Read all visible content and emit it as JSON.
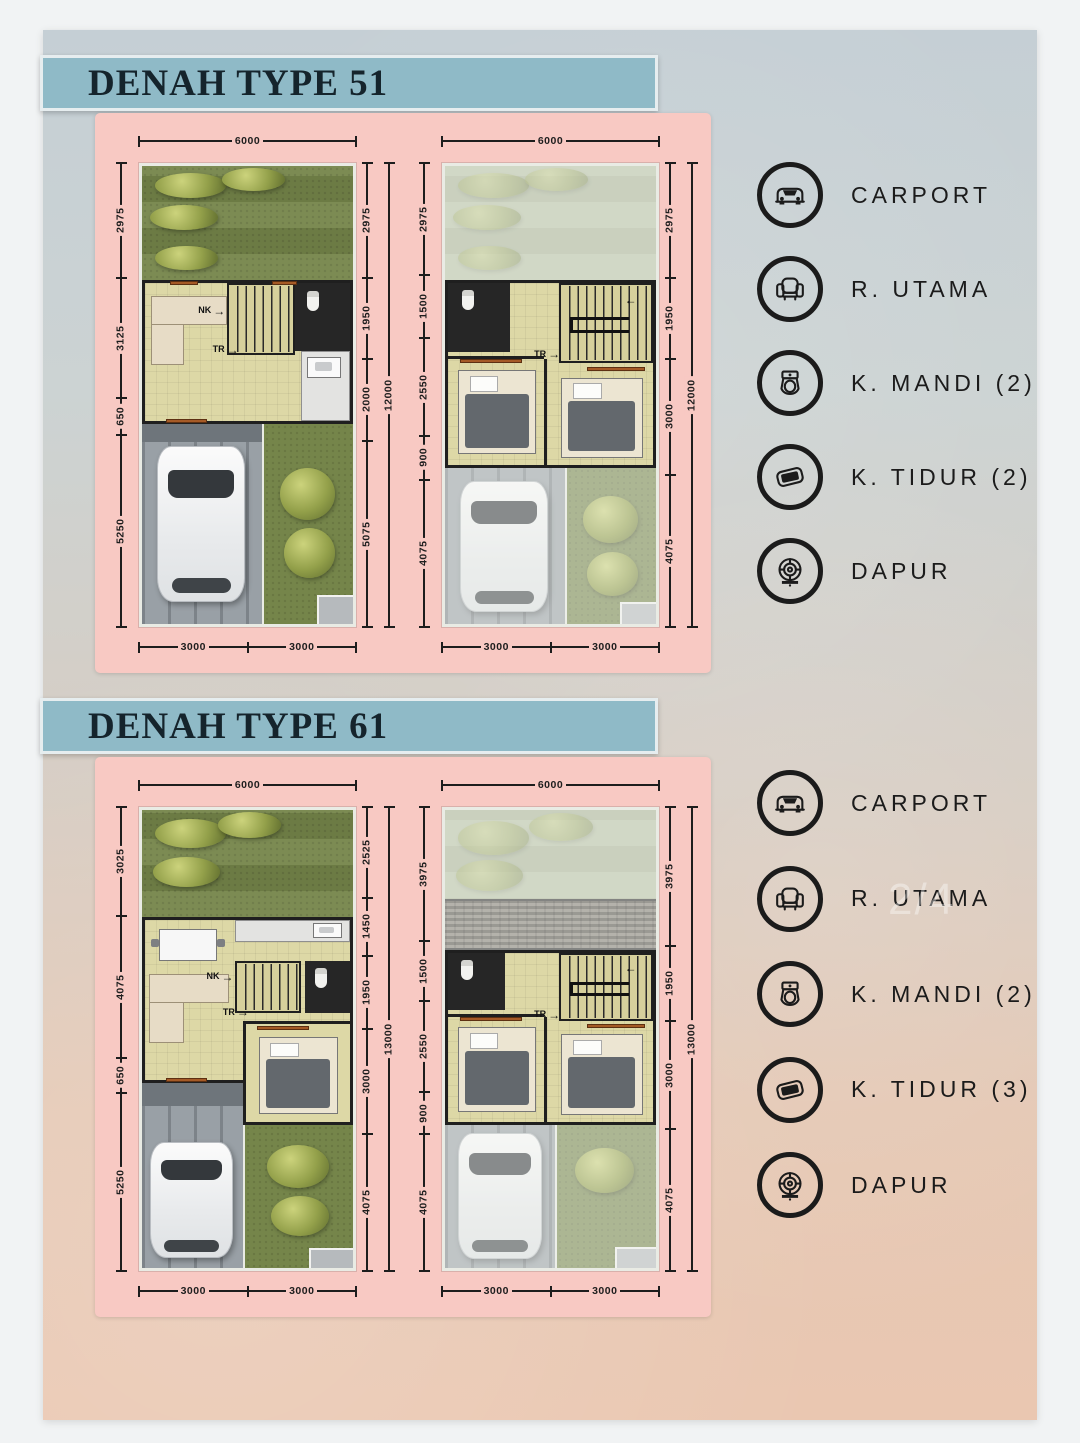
{
  "sections": [
    {
      "title": "DENAH TYPE 51",
      "plans": {
        "ground": {
          "top": "6000",
          "left": [
            "2975",
            "3125",
            "650",
            "5250"
          ],
          "right": [
            "2975",
            "1950",
            "2000",
            "5075"
          ],
          "overall": "12000",
          "bottom": [
            "3000",
            "3000"
          ]
        },
        "upper": {
          "top": "6000",
          "left": [
            "2975",
            "1500",
            "2550",
            "900",
            "4075"
          ],
          "right": [
            "2975",
            "1950",
            "3000",
            "4075"
          ],
          "overall": "12000",
          "bottom": [
            "3000",
            "3000"
          ]
        }
      },
      "legend": [
        {
          "icon": "car-icon",
          "label": "CARPORT"
        },
        {
          "icon": "armchair-icon",
          "label": "R. UTAMA"
        },
        {
          "icon": "toilet-icon",
          "label": "K. MANDI (2)"
        },
        {
          "icon": "pillow-icon",
          "label": "K. TIDUR (2)"
        },
        {
          "icon": "stove-icon",
          "label": "DAPUR"
        }
      ]
    },
    {
      "title": "DENAH TYPE 61",
      "plans": {
        "ground": {
          "top": "6000",
          "left": [
            "3025",
            "4075",
            "650",
            "5250"
          ],
          "right": [
            "2525",
            "1450",
            "1950",
            "3000",
            "4075"
          ],
          "overall": "13000",
          "bottom": [
            "3000",
            "3000"
          ]
        },
        "upper": {
          "top": "6000",
          "left": [
            "3975",
            "1500",
            "2550",
            "900",
            "4075"
          ],
          "right": [
            "3975",
            "1950",
            "3000",
            "4075"
          ],
          "overall": "13000",
          "bottom": [
            "3000",
            "3000"
          ]
        }
      },
      "legend": [
        {
          "icon": "car-icon",
          "label": "CARPORT"
        },
        {
          "icon": "armchair-icon",
          "label": "R. UTAMA"
        },
        {
          "icon": "toilet-icon",
          "label": "K. MANDI (2)"
        },
        {
          "icon": "pillow-icon",
          "label": "K. TIDUR (3)"
        },
        {
          "icon": "stove-icon",
          "label": "DAPUR"
        }
      ],
      "watermark": "2/4"
    }
  ],
  "stair_labels": {
    "up": "NK",
    "down": "TR",
    "arrow_right": "→",
    "arrow_left": "←"
  },
  "colors": {
    "banner": "#8fbac7",
    "panel_pink": "#f8c9c3",
    "legend_ink": "#1b1b1b"
  }
}
